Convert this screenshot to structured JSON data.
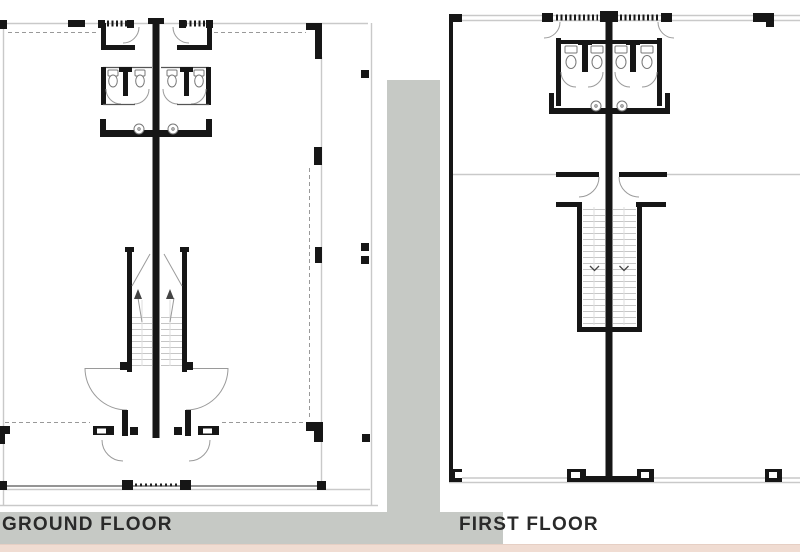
{
  "labels": {
    "ground_floor": "GROUND FLOOR",
    "first_floor": "FIRST FLOOR"
  },
  "colors": {
    "line_black": "#161616",
    "line_light": "#c9c9c9",
    "line_mid": "#999999",
    "band_gray": "#c6c9c5",
    "strip_pink": "#f0dcd2",
    "label_text": "#2a2a2a",
    "page_bg": "#ffffff"
  }
}
